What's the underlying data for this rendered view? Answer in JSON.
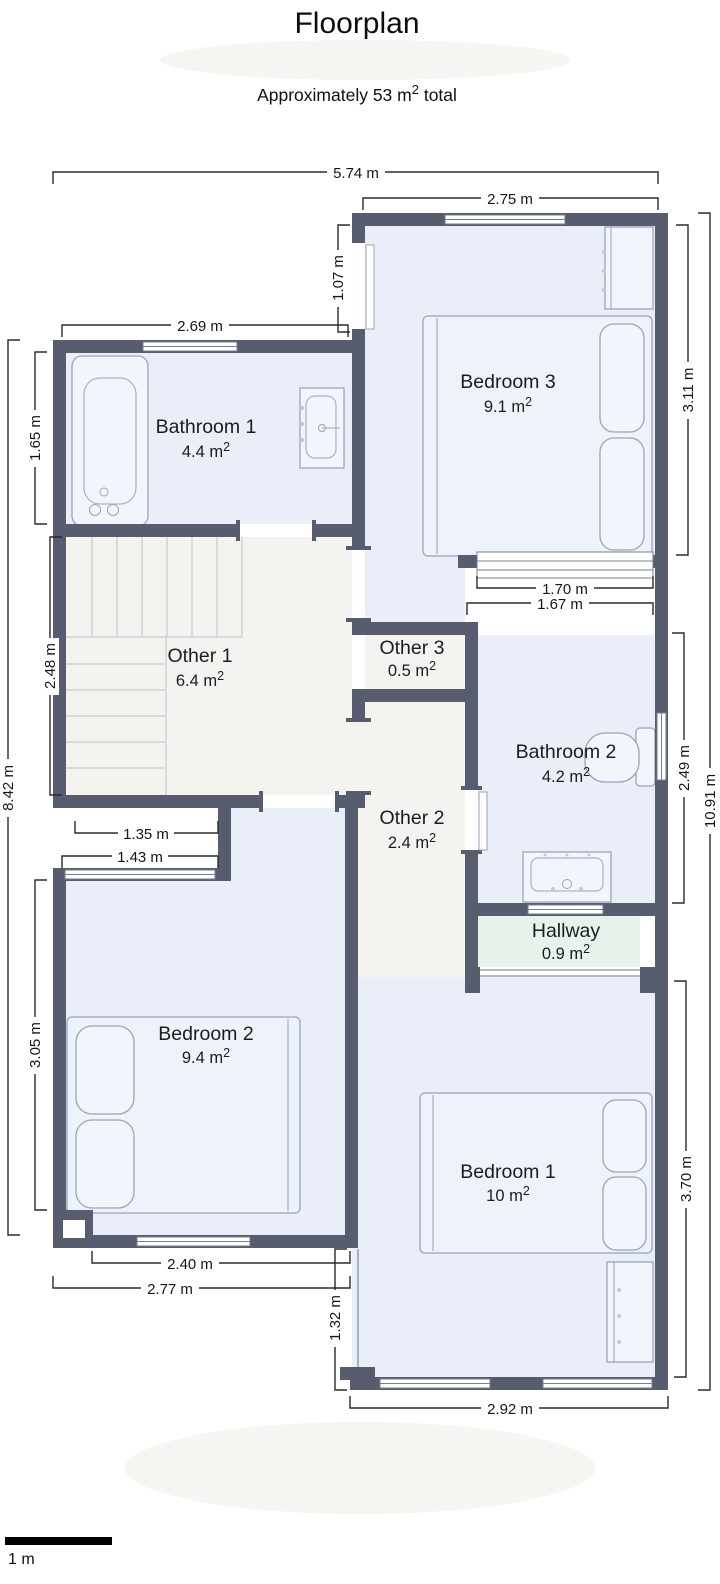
{
  "header": {
    "title": "Floorplan",
    "subtitle_prefix": "Approximately 53 m",
    "subtitle_sup": "2",
    "subtitle_suffix": " total"
  },
  "rooms": {
    "bedroom3": {
      "name": "Bedroom 3",
      "area": "9.1 m",
      "sup": "2"
    },
    "bathroom1": {
      "name": "Bathroom 1",
      "area": "4.4 m",
      "sup": "2"
    },
    "other1": {
      "name": "Other 1",
      "area": "6.4 m",
      "sup": "2"
    },
    "other3": {
      "name": "Other 3",
      "area": "0.5 m",
      "sup": "2"
    },
    "bathroom2": {
      "name": "Bathroom 2",
      "area": "4.2 m",
      "sup": "2"
    },
    "other2": {
      "name": "Other 2",
      "area": "2.4 m",
      "sup": "2"
    },
    "hallway": {
      "name": "Hallway",
      "area": "0.9 m",
      "sup": "2"
    },
    "bedroom2": {
      "name": "Bedroom 2",
      "area": "9.4 m",
      "sup": "2"
    },
    "bedroom1": {
      "name": "Bedroom 1",
      "area": "10 m",
      "sup": "2"
    }
  },
  "dims": {
    "overall_width": "5.74 m",
    "bedroom3_width": "2.75 m",
    "bathroom1_width": "2.69 m",
    "bedroom3_door_height": "1.07 m",
    "bedroom3_height": "3.11 m",
    "bathroom1_height": "1.65 m",
    "other1_height": "2.48 m",
    "left_total_height": "8.42 m",
    "right_total_height": "10.91 m",
    "bedroom3_window_width": "1.70 m",
    "bathroom2_width": "1.67 m",
    "bathroom2_height": "2.49 m",
    "stairs_width": "1.35 m",
    "bedroom2_top_width": "1.43 m",
    "bedroom2_height": "3.05 m",
    "bedroom2_window_width": "2.40 m",
    "bedroom2_width": "2.77 m",
    "bedroom1_left_height": "1.32 m",
    "bedroom1_width": "2.92 m",
    "bedroom1_height": "3.70 m"
  },
  "scale_bar": {
    "label": "1 m"
  },
  "colors": {
    "wall": "#575c6e",
    "room-blue": "#e9eef8",
    "room-neutral": "#f4f3f0",
    "room-green": "#e7f3ea",
    "dim-line": "#2b2b2b"
  }
}
